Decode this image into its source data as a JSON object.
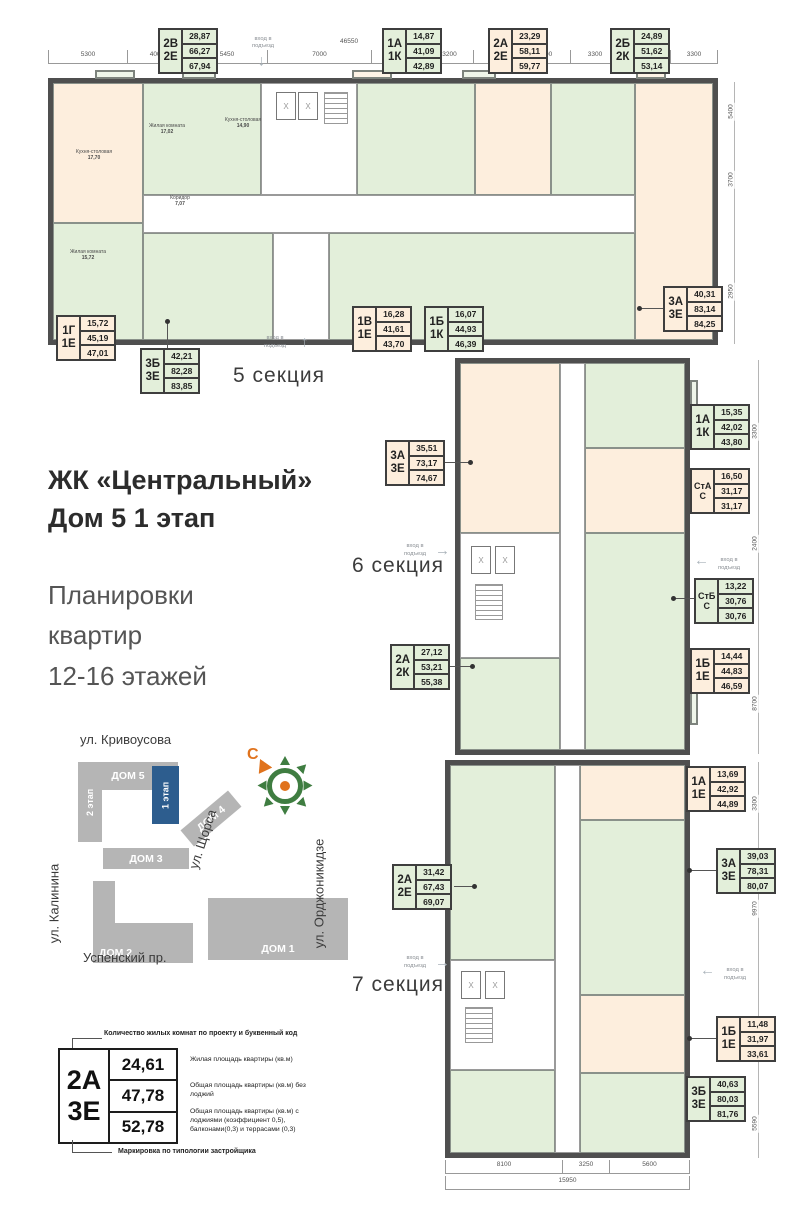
{
  "title": {
    "line1": "ЖК «Центральный»",
    "line2": "Дом 5  1 этап",
    "sub1": "Планировки",
    "sub2": "квартир",
    "sub3": "12-16 этажей"
  },
  "sections": {
    "s5": "5 секция",
    "s6": "6 секция",
    "s7": "7 секция"
  },
  "labels": {
    "entrance": "вход в подъезд"
  },
  "apartments": [
    {
      "code_top": "2В",
      "code_bottom": "2Е",
      "v1": "28,87",
      "v2": "66,27",
      "v3": "67,94"
    },
    {
      "code_top": "1А",
      "code_bottom": "1К",
      "v1": "14,87",
      "v2": "41,09",
      "v3": "42,89"
    },
    {
      "code_top": "2А",
      "code_bottom": "2Е",
      "v1": "23,29",
      "v2": "58,11",
      "v3": "59,77"
    },
    {
      "code_top": "2Б",
      "code_bottom": "2К",
      "v1": "24,89",
      "v2": "51,62",
      "v3": "53,14"
    },
    {
      "code_top": "1Г",
      "code_bottom": "1Е",
      "v1": "15,72",
      "v2": "45,19",
      "v3": "47,01"
    },
    {
      "code_top": "3Б",
      "code_bottom": "3Е",
      "v1": "42,21",
      "v2": "82,28",
      "v3": "83,85"
    },
    {
      "code_top": "1В",
      "code_bottom": "1Е",
      "v1": "16,28",
      "v2": "41,61",
      "v3": "43,70"
    },
    {
      "code_top": "1Б",
      "code_bottom": "1К",
      "v1": "16,07",
      "v2": "44,93",
      "v3": "46,39"
    },
    {
      "code_top": "3А",
      "code_bottom": "3Е",
      "v1": "40,31",
      "v2": "83,14",
      "v3": "84,25"
    },
    {
      "code_top": "3А",
      "code_bottom": "3Е",
      "v1": "35,51",
      "v2": "73,17",
      "v3": "74,67"
    },
    {
      "code_top": "1А",
      "code_bottom": "1К",
      "v1": "15,35",
      "v2": "42,02",
      "v3": "43,80"
    },
    {
      "code_top": "СтА",
      "code_bottom": "С",
      "v1": "16,50",
      "v2": "31,17",
      "v3": "31,17"
    },
    {
      "code_top": "СтБ",
      "code_bottom": "С",
      "v1": "13,22",
      "v2": "30,76",
      "v3": "30,76"
    },
    {
      "code_top": "1Б",
      "code_bottom": "1Е",
      "v1": "14,44",
      "v2": "44,83",
      "v3": "46,59"
    },
    {
      "code_top": "2А",
      "code_bottom": "2К",
      "v1": "27,12",
      "v2": "53,21",
      "v3": "55,38"
    },
    {
      "code_top": "1А",
      "code_bottom": "1Е",
      "v1": "13,69",
      "v2": "42,92",
      "v3": "44,89"
    },
    {
      "code_top": "3А",
      "code_bottom": "3Е",
      "v1": "39,03",
      "v2": "78,31",
      "v3": "80,07"
    },
    {
      "code_top": "2А",
      "code_bottom": "2Е",
      "v1": "31,42",
      "v2": "67,43",
      "v3": "69,07"
    },
    {
      "code_top": "1Б",
      "code_bottom": "1Е",
      "v1": "11,48",
      "v2": "31,97",
      "v3": "33,61"
    },
    {
      "code_top": "3Б",
      "code_bottom": "3Е",
      "v1": "40,63",
      "v2": "80,03",
      "v3": "81,76"
    }
  ],
  "dims": {
    "overall_top": "46550",
    "under_box": "2750",
    "top": [
      "5300",
      "4000",
      "5450",
      "7000",
      "3680",
      "3200",
      "3100",
      "3400",
      "3300",
      "3400",
      "3300"
    ],
    "right_s5": [
      "5400",
      "3700",
      "2950"
    ],
    "right_s6": [
      "3300",
      "2400",
      "8700"
    ],
    "right_s7": [
      "3300",
      "9970",
      "5590"
    ],
    "bottom": [
      "8100",
      "3250",
      "5600"
    ],
    "overall_bottom": "15950"
  },
  "rooms_s5": [
    {
      "name": "Кухня-столовая",
      "area": "17,70"
    },
    {
      "name": "Жилая комната",
      "area": "17,02"
    },
    {
      "name": "Кухня-столовая",
      "area": "14,90"
    },
    {
      "name": "Коридор",
      "area": "7,07"
    },
    {
      "name": "Жилая комната",
      "area": "15,72"
    }
  ],
  "site_map": {
    "street_top": "ул. Кривоусова",
    "street_left": "ул. Калинина",
    "street_diag": "ул. Щорса",
    "street_right": "ул. Орджоникидзе",
    "street_bottom": "Успенский пр.",
    "bld5": "ДОМ 5",
    "bld4": "ДОМ 4",
    "bld3": "ДОМ 3",
    "bld2": "ДОМ 2",
    "bld1": "ДОМ 1",
    "stage1": "1 этап",
    "stage2": "2 этап",
    "compass_n": "С"
  },
  "legend": {
    "top_note": "Количество жилых комнат по проекту и буквенный код",
    "code_top": "2А",
    "code_bottom": "3Е",
    "v1": "24,61",
    "v2": "47,78",
    "v3": "52,78",
    "row1": "Жилая площадь квартиры (кв.м)",
    "row2": "Общая площадь квартиры (кв.м) без лоджий",
    "row3": "Общая площадь квартиры (кв.м) с лоджиями (коэффициент 0,5), балконами(0,3) и террасами (0,3)",
    "bottom_note": "Маркировка по типологии застройщика"
  },
  "colors": {
    "apartment_green": "#e3efda",
    "apartment_orange": "#fdeedd",
    "wall": "#4f4f4f",
    "stage_blue": "#2d5d8e",
    "building_gray": "#b5b5b5",
    "compass_green": "#3f7d41",
    "compass_orange": "#e0731d"
  }
}
